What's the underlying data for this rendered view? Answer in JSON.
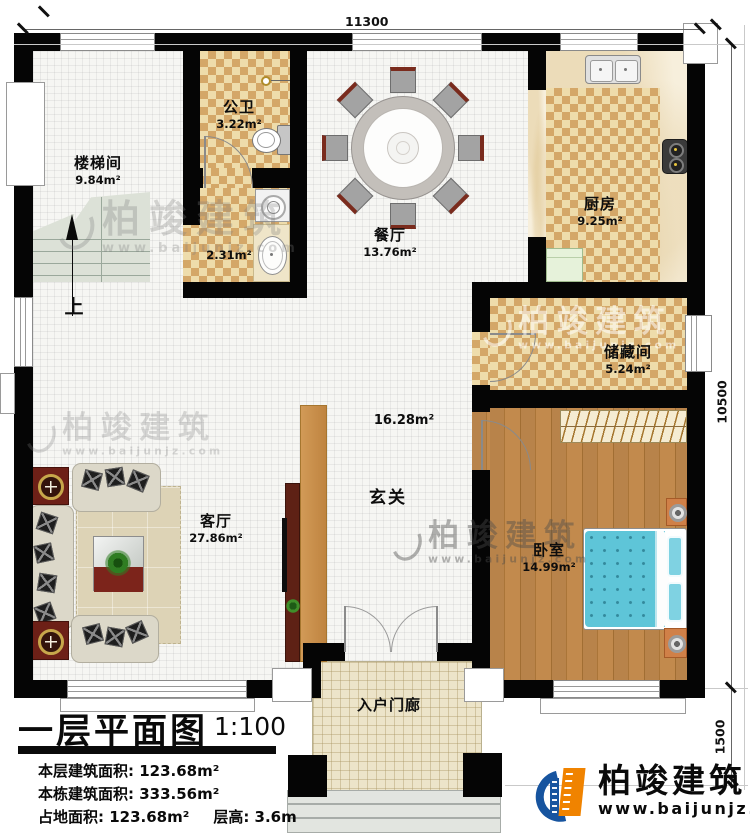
{
  "dimensions": {
    "top": "11300",
    "right_main": "10500",
    "right_porch": "1500"
  },
  "rooms": {
    "stairwell": {
      "name": "楼梯间",
      "area": "9.84m²"
    },
    "bathroom": {
      "name": "公卫",
      "area": "3.22m²"
    },
    "laundry": {
      "area": "2.31m²"
    },
    "dining": {
      "name": "餐厅",
      "area": "13.76m²"
    },
    "kitchen": {
      "name": "厨房",
      "area": "9.25m²"
    },
    "storage": {
      "name": "储藏间",
      "area": "5.24m²"
    },
    "hall": {
      "name": "玄关",
      "area": "16.28m²"
    },
    "living": {
      "name": "客厅",
      "area": "27.86m²"
    },
    "bedroom": {
      "name": "卧室",
      "area": "14.99m²"
    },
    "porch": {
      "name": "入户门廊"
    }
  },
  "stairs": {
    "up_label": "上"
  },
  "title_block": {
    "title": "一层平面图",
    "scale": "1:100",
    "lines": [
      "本层建筑面积: 123.68m²",
      "本栋建筑面积: 333.56m²",
      "占地面积: 123.68m²",
      "层高: 3.6m"
    ]
  },
  "branding": {
    "name": "柏竣建筑",
    "website": "www.baijunjz.com"
  },
  "watermark": {
    "name": "柏竣建筑",
    "website": "www.baijunjz.com"
  },
  "colors": {
    "wall": "#050505",
    "checker_dark": "#d4a768",
    "checker_light": "#eedcab",
    "wood": "#b5813f",
    "bed_teal": "#5ec5d8",
    "logo_blue": "#17549f",
    "logo_orange": "#f08300"
  }
}
